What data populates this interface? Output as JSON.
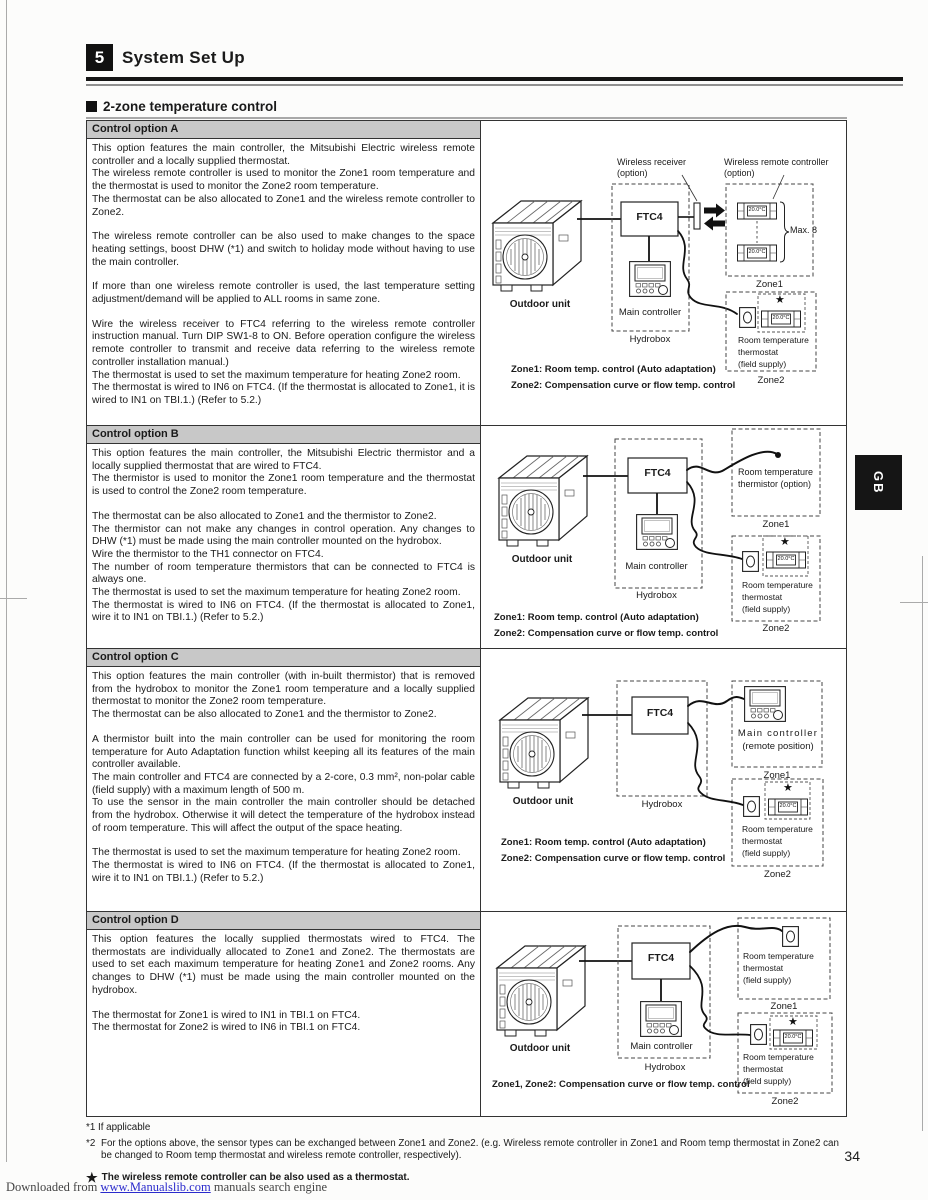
{
  "header": {
    "section_number": "5",
    "section_title": "System Set Up",
    "subsection_title": "2-zone temperature control"
  },
  "side_tab": {
    "label": "GB"
  },
  "options": [
    {
      "header": "Control option A",
      "paragraphs": [
        "This option features the main controller, the Mitsubishi Electric wireless remote controller and a locally supplied thermostat.",
        "The wireless remote controller is used to monitor the Zone1 room temperature and the thermostat is used to monitor the Zone2 room temperature.",
        "The thermostat can be also allocated to Zone1 and the wireless remote controller to Zone2.",
        "",
        "The wireless remote controller can be also used to make changes to the space heating settings, boost DHW (*1) and switch to holiday mode without having to use the main controller.",
        "",
        "If more than one wireless remote controller is used, the last temperature setting adjustment/demand will be applied to ALL rooms in same zone.",
        "",
        "Wire the wireless receiver to FTC4 referring to the wireless remote controller instruction manual. Turn DIP SW1-8 to ON. Before operation configure the wireless remote controller to transmit and receive data referring to the wireless remote controller installation manual.)",
        "The thermostat is used to set the maximum temperature for heating Zone2 room.",
        "The thermostat is wired to IN6 on FTC4. (If the thermostat is allocated to Zone1, it is wired to IN1 on TBI.1.) (Refer to 5.2.)"
      ],
      "diagram": {
        "wireless_receiver_1": "Wireless receiver",
        "wireless_receiver_2": "(option)",
        "wireless_remote_1": "Wireless remote controller",
        "wireless_remote_2": "(option)",
        "ftc4": "FTC4",
        "max8": "Max. 8",
        "outdoor_unit": "Outdoor unit",
        "main_controller": "Main controller",
        "hydrobox": "Hydrobox",
        "zone1": "Zone1",
        "zone2": "Zone2",
        "temp1": "20.0°C",
        "temp2": "20.0°C",
        "temp3": "20.0°C",
        "star": "★",
        "thermostat_1": "Room temperature",
        "thermostat_2": "thermostat",
        "thermostat_3": "(field supply)",
        "caption1": "Zone1: Room temp. control (Auto adaptation)",
        "caption2": "Zone2: Compensation curve or flow temp. control"
      }
    },
    {
      "header": "Control option B",
      "paragraphs": [
        "This option features the main controller, the Mitsubishi Electric thermistor and a locally supplied thermostat that are wired to FTC4.",
        "The thermistor is used to monitor the Zone1 room temperature and the thermostat is used to control the Zone2 room temperature.",
        "",
        "The thermostat can be also allocated to Zone1 and the thermistor to Zone2.",
        "The thermistor can not make any changes in control operation. Any changes to DHW (*1) must be made using the main controller mounted on the hydrobox.",
        "Wire the thermistor to the TH1 connector on FTC4.",
        "The number of room temperature thermistors that can be connected to FTC4 is always one.",
        "The thermostat is used to set the maximum temperature for heating Zone2 room.",
        "The thermostat is wired to IN6 on FTC4. (If the thermostat is allocated to Zone1, wire it to IN1 on TBI.1.) (Refer to 5.2.)"
      ],
      "diagram": {
        "ftc4": "FTC4",
        "outdoor_unit": "Outdoor unit",
        "main_controller": "Main controller",
        "hydrobox": "Hydrobox",
        "thermistor_1": "Room temperature",
        "thermistor_2": "thermistor (option)",
        "zone1": "Zone1",
        "zone2": "Zone2",
        "temp": "20.0°C",
        "star": "★",
        "thermostat_1": "Room temperature",
        "thermostat_2": "thermostat",
        "thermostat_3": "(field supply)",
        "caption1": "Zone1: Room temp. control (Auto adaptation)",
        "caption2": "Zone2: Compensation curve or flow temp. control"
      }
    },
    {
      "header": "Control option C",
      "paragraphs": [
        "This option features the main controller (with in-built thermistor) that is removed from the hydrobox to monitor the Zone1 room temperature and a locally supplied thermostat to monitor the Zone2 room temperature.",
        "The thermostat can be also allocated to Zone1 and the thermistor to Zone2.",
        "",
        "A thermistor built into the main controller can be used for monitoring the room temperature for Auto Adaptation function whilst keeping all its features of the main controller available.",
        "The main controller and FTC4 are connected by a 2-core, 0.3 mm², non-polar cable (field supply) with a maximum length of 500 m.",
        "To use the sensor in the main controller the main controller should be detached from the hydrobox. Otherwise it will detect the temperature of the hydrobox instead of room temperature. This will affect the output of the space heating.",
        "",
        "The thermostat is used to set the maximum temperature for heating Zone2 room.",
        "The thermostat is wired to IN6 on FTC4. (If the thermostat is allocated to Zone1, wire it to IN1 on TBI.1.)  (Refer to 5.2.)"
      ],
      "diagram": {
        "ftc4": "FTC4",
        "outdoor_unit": "Outdoor unit",
        "hydrobox": "Hydrobox",
        "main_controller_1": "Main controller",
        "main_controller_2": "(remote position)",
        "zone1": "Zone1",
        "zone2": "Zone2",
        "temp": "20.0°C",
        "star": "★",
        "thermostat_1": "Room temperature",
        "thermostat_2": "thermostat",
        "thermostat_3": "(field supply)",
        "caption1": "Zone1: Room temp. control (Auto adaptation)",
        "caption2": "Zone2: Compensation curve or flow temp. control"
      }
    },
    {
      "header": "Control option D",
      "paragraphs": [
        "This option features the locally supplied thermostats wired to FTC4. The thermostats are individually allocated to Zone1 and Zone2. The thermostats are used to set each maximum temperature for heating Zone1 and Zone2 rooms. Any changes to DHW (*1) must be made using the main controller mounted on the hydrobox.",
        "",
        "The thermostat for Zone1 is wired to IN1 in TBI.1 on FTC4.",
        "The thermostat for Zone2 is wired to IN6 in TBI.1 on FTC4."
      ],
      "diagram": {
        "ftc4": "FTC4",
        "outdoor_unit": "Outdoor unit",
        "main_controller": "Main controller",
        "hydrobox": "Hydrobox",
        "zone1": "Zone1",
        "zone2": "Zone2",
        "temp": "20.0°C",
        "star": "★",
        "thermostat1_1": "Room temperature",
        "thermostat1_2": "thermostat",
        "thermostat1_3": "(field supply)",
        "thermostat2_1": "Room temperature",
        "thermostat2_2": "thermostat",
        "thermostat2_3": "(field supply)",
        "caption1": "Zone1, Zone2: Compensation curve or flow temp. control"
      }
    }
  ],
  "footnotes": {
    "note1": "*1 If applicable",
    "note2_marker": "*2",
    "note2_text": "For the options above, the sensor types can be exchanged between Zone1 and Zone2. (e.g. Wireless remote controller in Zone1 and Room temp thermostat in Zone2 can be changed to Room temp thermostat and wireless remote controller, respectively).",
    "star_symbol": "★",
    "star_note": "The wireless remote controller can be also used as a thermostat."
  },
  "page_number": "34",
  "watermark": {
    "prefix": "Downloaded from ",
    "link": "www.Manualslib.com",
    "suffix": " manuals search engine"
  }
}
